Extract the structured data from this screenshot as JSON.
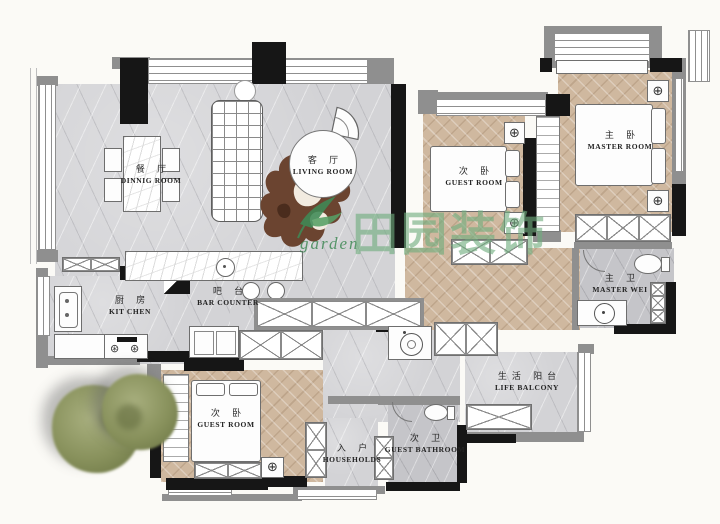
{
  "brand": {
    "logo_script": "garden",
    "name": "田园装饰"
  },
  "rooms": {
    "dining": {
      "zh": "餐 厅",
      "en": "DINNIG ROOM"
    },
    "living": {
      "zh": "客 厅",
      "en": "LIVING ROOM"
    },
    "guest_top": {
      "zh": "次 卧",
      "en": "GUEST ROOM"
    },
    "master": {
      "zh": "主 卧",
      "en": "MASTER ROOM"
    },
    "kitchen": {
      "zh": "厨 房",
      "en": "KIT CHEN"
    },
    "bar": {
      "zh": "吧 台",
      "en": "BAR COUNTER"
    },
    "master_bath": {
      "zh": "主 卫",
      "en": "MASTER WEI"
    },
    "life_balcony": {
      "zh": "生活 阳台",
      "en": "LIFE BALCONY"
    },
    "guest_bottom": {
      "zh": "次 卧",
      "en": "GUEST ROOM"
    },
    "entry": {
      "zh": "入 户",
      "en": "HOUSEHOLDS"
    },
    "guest_bath": {
      "zh": "次 卫",
      "en": "GUEST BATHROOM"
    }
  },
  "icons": {
    "ceiling_light_symbol": "⊕",
    "burner_symbol": "⊛"
  },
  "colors": {
    "wood": "#cfb89f",
    "tile": "#d3d3d6",
    "wall_black": "#161616",
    "wall_gray": "#8f8f8f",
    "watermark_green": "#70ac7e",
    "rug_brown": "#6b4430",
    "tree_green": "#88915c"
  }
}
